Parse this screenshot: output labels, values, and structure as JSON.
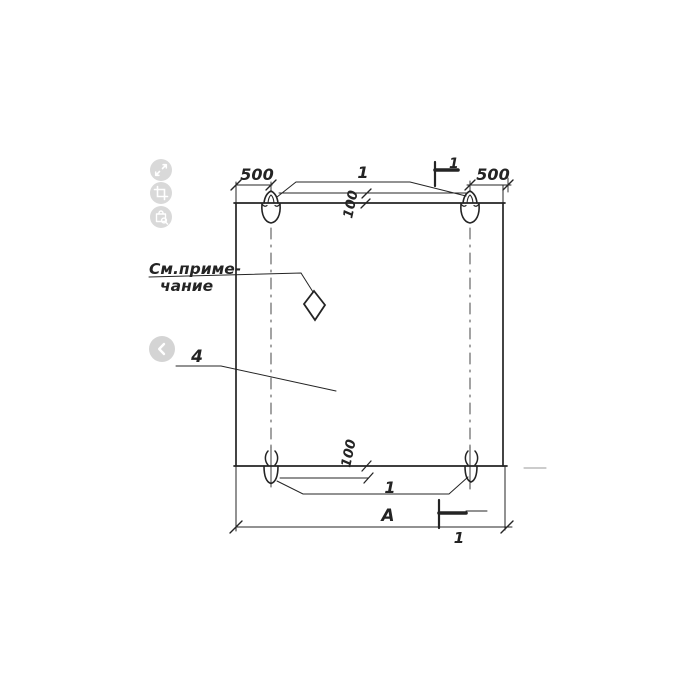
{
  "viewer": {
    "icons": [
      "expand-icon",
      "crop-icon",
      "bag-search-icon",
      "chevron-left-icon"
    ]
  },
  "drawing": {
    "note": {
      "line1": "См.приме-",
      "line2": "чание"
    },
    "dims": {
      "left_500": "500",
      "right_500": "500",
      "top_100": "100",
      "bottom_100": "100",
      "width": "A"
    },
    "positions": {
      "loops_top": "1",
      "loops_bottom": "1",
      "panel": "4"
    },
    "sections": {
      "top": "1",
      "bottom": "1"
    },
    "colors": {
      "ink": "#242424",
      "dim_gray": "#9a9a9a",
      "control_bg": "#d9d9d9"
    }
  }
}
